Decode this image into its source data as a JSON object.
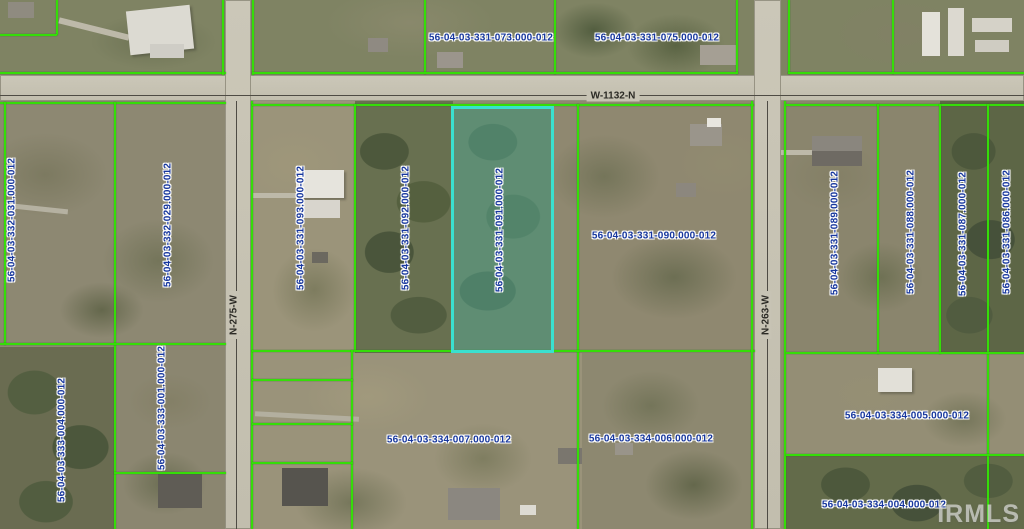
{
  "map": {
    "type": "parcel-aerial-view",
    "watermark": "IRMLS",
    "highlighted_parcel": "56-04-03-331-091.000-012",
    "roads": [
      {
        "name": "W-1132-N",
        "orientation": "horizontal"
      },
      {
        "name": "N-275-W",
        "orientation": "vertical"
      },
      {
        "name": "N-263-W",
        "orientation": "vertical"
      }
    ],
    "parcels": [
      {
        "id": "56-04-03-331-073.000-012",
        "highlighted": false
      },
      {
        "id": "56-04-03-331-075.000-012",
        "highlighted": false
      },
      {
        "id": "56-04-03-332-031.000-012",
        "highlighted": false
      },
      {
        "id": "56-04-03-332-029.000-012",
        "highlighted": false
      },
      {
        "id": "56-04-03-331-093.000-012",
        "highlighted": false
      },
      {
        "id": "56-04-03-331-092.000-012",
        "highlighted": false
      },
      {
        "id": "56-04-03-331-091.000-012",
        "highlighted": true
      },
      {
        "id": "56-04-03-331-090.000-012",
        "highlighted": false
      },
      {
        "id": "56-04-03-331-089.000-012",
        "highlighted": false
      },
      {
        "id": "56-04-03-331-088.000-012",
        "highlighted": false
      },
      {
        "id": "56-04-03-331-087.000-012",
        "highlighted": false
      },
      {
        "id": "56-04-03-331-086.000-012",
        "highlighted": false
      },
      {
        "id": "56-04-03-333-004.000-012",
        "highlighted": false
      },
      {
        "id": "56-04-03-333-001.000-012",
        "highlighted": false
      },
      {
        "id": "56-04-03-334-007.000-012",
        "highlighted": false
      },
      {
        "id": "56-04-03-334-006.000-012",
        "highlighted": false
      },
      {
        "id": "56-04-03-334-005.000-012",
        "highlighted": false
      },
      {
        "id": "56-04-03-334-004.000-012",
        "highlighted": false
      }
    ],
    "colors": {
      "parcel_line": "#35dd08",
      "highlight_border": "#3ae0cf",
      "highlight_fill": "rgba(90,210,192,0.34)",
      "parcel_label_text": "#17379e",
      "parcel_label_halo": "#ffffff",
      "road_surface": "#c7c3b4",
      "road_label_text": "#2b2a25",
      "watermark_color": "rgba(244,244,244,0.6)"
    }
  }
}
